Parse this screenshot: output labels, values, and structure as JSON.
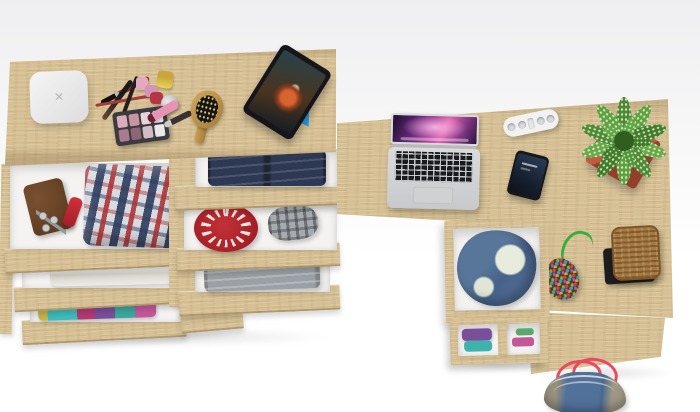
{
  "scene": {
    "title": "Top view 3D render: oak dressing table and corner desk with open drawers",
    "background_top": "#efeff1",
    "background_bottom": "#ffffff",
    "wood_color": "#d6c094"
  },
  "dressing_table": {
    "label": "oak dressing table with two columns of open drawers",
    "tabletop_items": {
      "white_device": {
        "label": "white square device with x logo",
        "glyph": "✕",
        "color": "#ededee"
      },
      "makeup_brushes": {
        "label": "makeup brushes and pencils",
        "colors": [
          "#8f2f2c",
          "#1a1a1a",
          "#a33b36"
        ]
      },
      "nail_polish": {
        "label": "nail polish bottles and cosmetic jar",
        "colors": [
          "#e0c04a",
          "#e2a9c0",
          "#d695b5",
          "#b53544",
          "#a9acb0"
        ]
      },
      "eyeshadow_palette": {
        "label": "eyeshadow palette",
        "case_color": "#3b3a3e",
        "pan_colors": [
          "#d9aebb",
          "#c794a6",
          "#e6d4da",
          "#f1eef0",
          "#a87c8e",
          "#8e6477",
          "#d3bcc6",
          "#e9e9ea"
        ]
      },
      "lip_gloss": {
        "label": "pink lip gloss tube",
        "color": "#e893b4"
      },
      "eyeliner": {
        "label": "eyeliner pen",
        "color": "#3a3134"
      },
      "hairbrush": {
        "label": "wooden hairbrush",
        "color": "#c49a52"
      },
      "tablet": {
        "label": "tablet on blue stand playing a movie",
        "bezel_color": "#16161a",
        "stand_color": "#2e9fe6"
      }
    },
    "drawers": {
      "left_column": [
        {
          "contents": [
            "brown wallet",
            "key ring with keys",
            "red pocket knife",
            "red and navy plaid shirt"
          ]
        },
        {
          "contents": [
            "folded white towel"
          ]
        },
        {
          "contents": [
            "colorful folded clothes"
          ]
        }
      ],
      "right_column": [
        {
          "contents": [
            "folded dark blue jeans"
          ]
        },
        {
          "contents": [
            "red knitted hat",
            "grey plaid flat cap"
          ]
        },
        {
          "contents": [
            "folded grey trousers"
          ]
        }
      ]
    }
  },
  "corner_desk": {
    "label": "oak corner desk with drawer pedestal",
    "desktop_items": {
      "laptop": {
        "label": "open silver laptop with purple space wallpaper",
        "body_color": "#d7d8da"
      },
      "power_strip": {
        "label": "white power strip with four sockets",
        "color": "#f2f2f3"
      },
      "smartphone": {
        "label": "smartphone with dark lock screen",
        "color": "#17181c"
      },
      "plant": {
        "label": "green potted plant in red square pot",
        "pot_color": "#b55038",
        "leaf_colors": [
          "#4d8a33",
          "#5ea23f",
          "#417c2a",
          "#66a946"
        ]
      },
      "beaded_pouch": {
        "label": "multicolor beaded pouch with green cord",
        "cord_color": "#35b03c"
      },
      "basket": {
        "label": "woven basket on black stand",
        "color": "#a5793f",
        "stand_color": "#1d1d1f"
      }
    },
    "pedestal_drawers": [
      {
        "contents": [
          "blue denim jacket with cream lining"
        ]
      },
      {
        "contents": [
          "folded purple and teal clothes"
        ]
      }
    ]
  },
  "floor_items": {
    "duffel_bag": {
      "label": "denim duffel bag with pink handles",
      "colors": [
        "#51719b",
        "#98907e",
        "#e84a60"
      ]
    }
  }
}
